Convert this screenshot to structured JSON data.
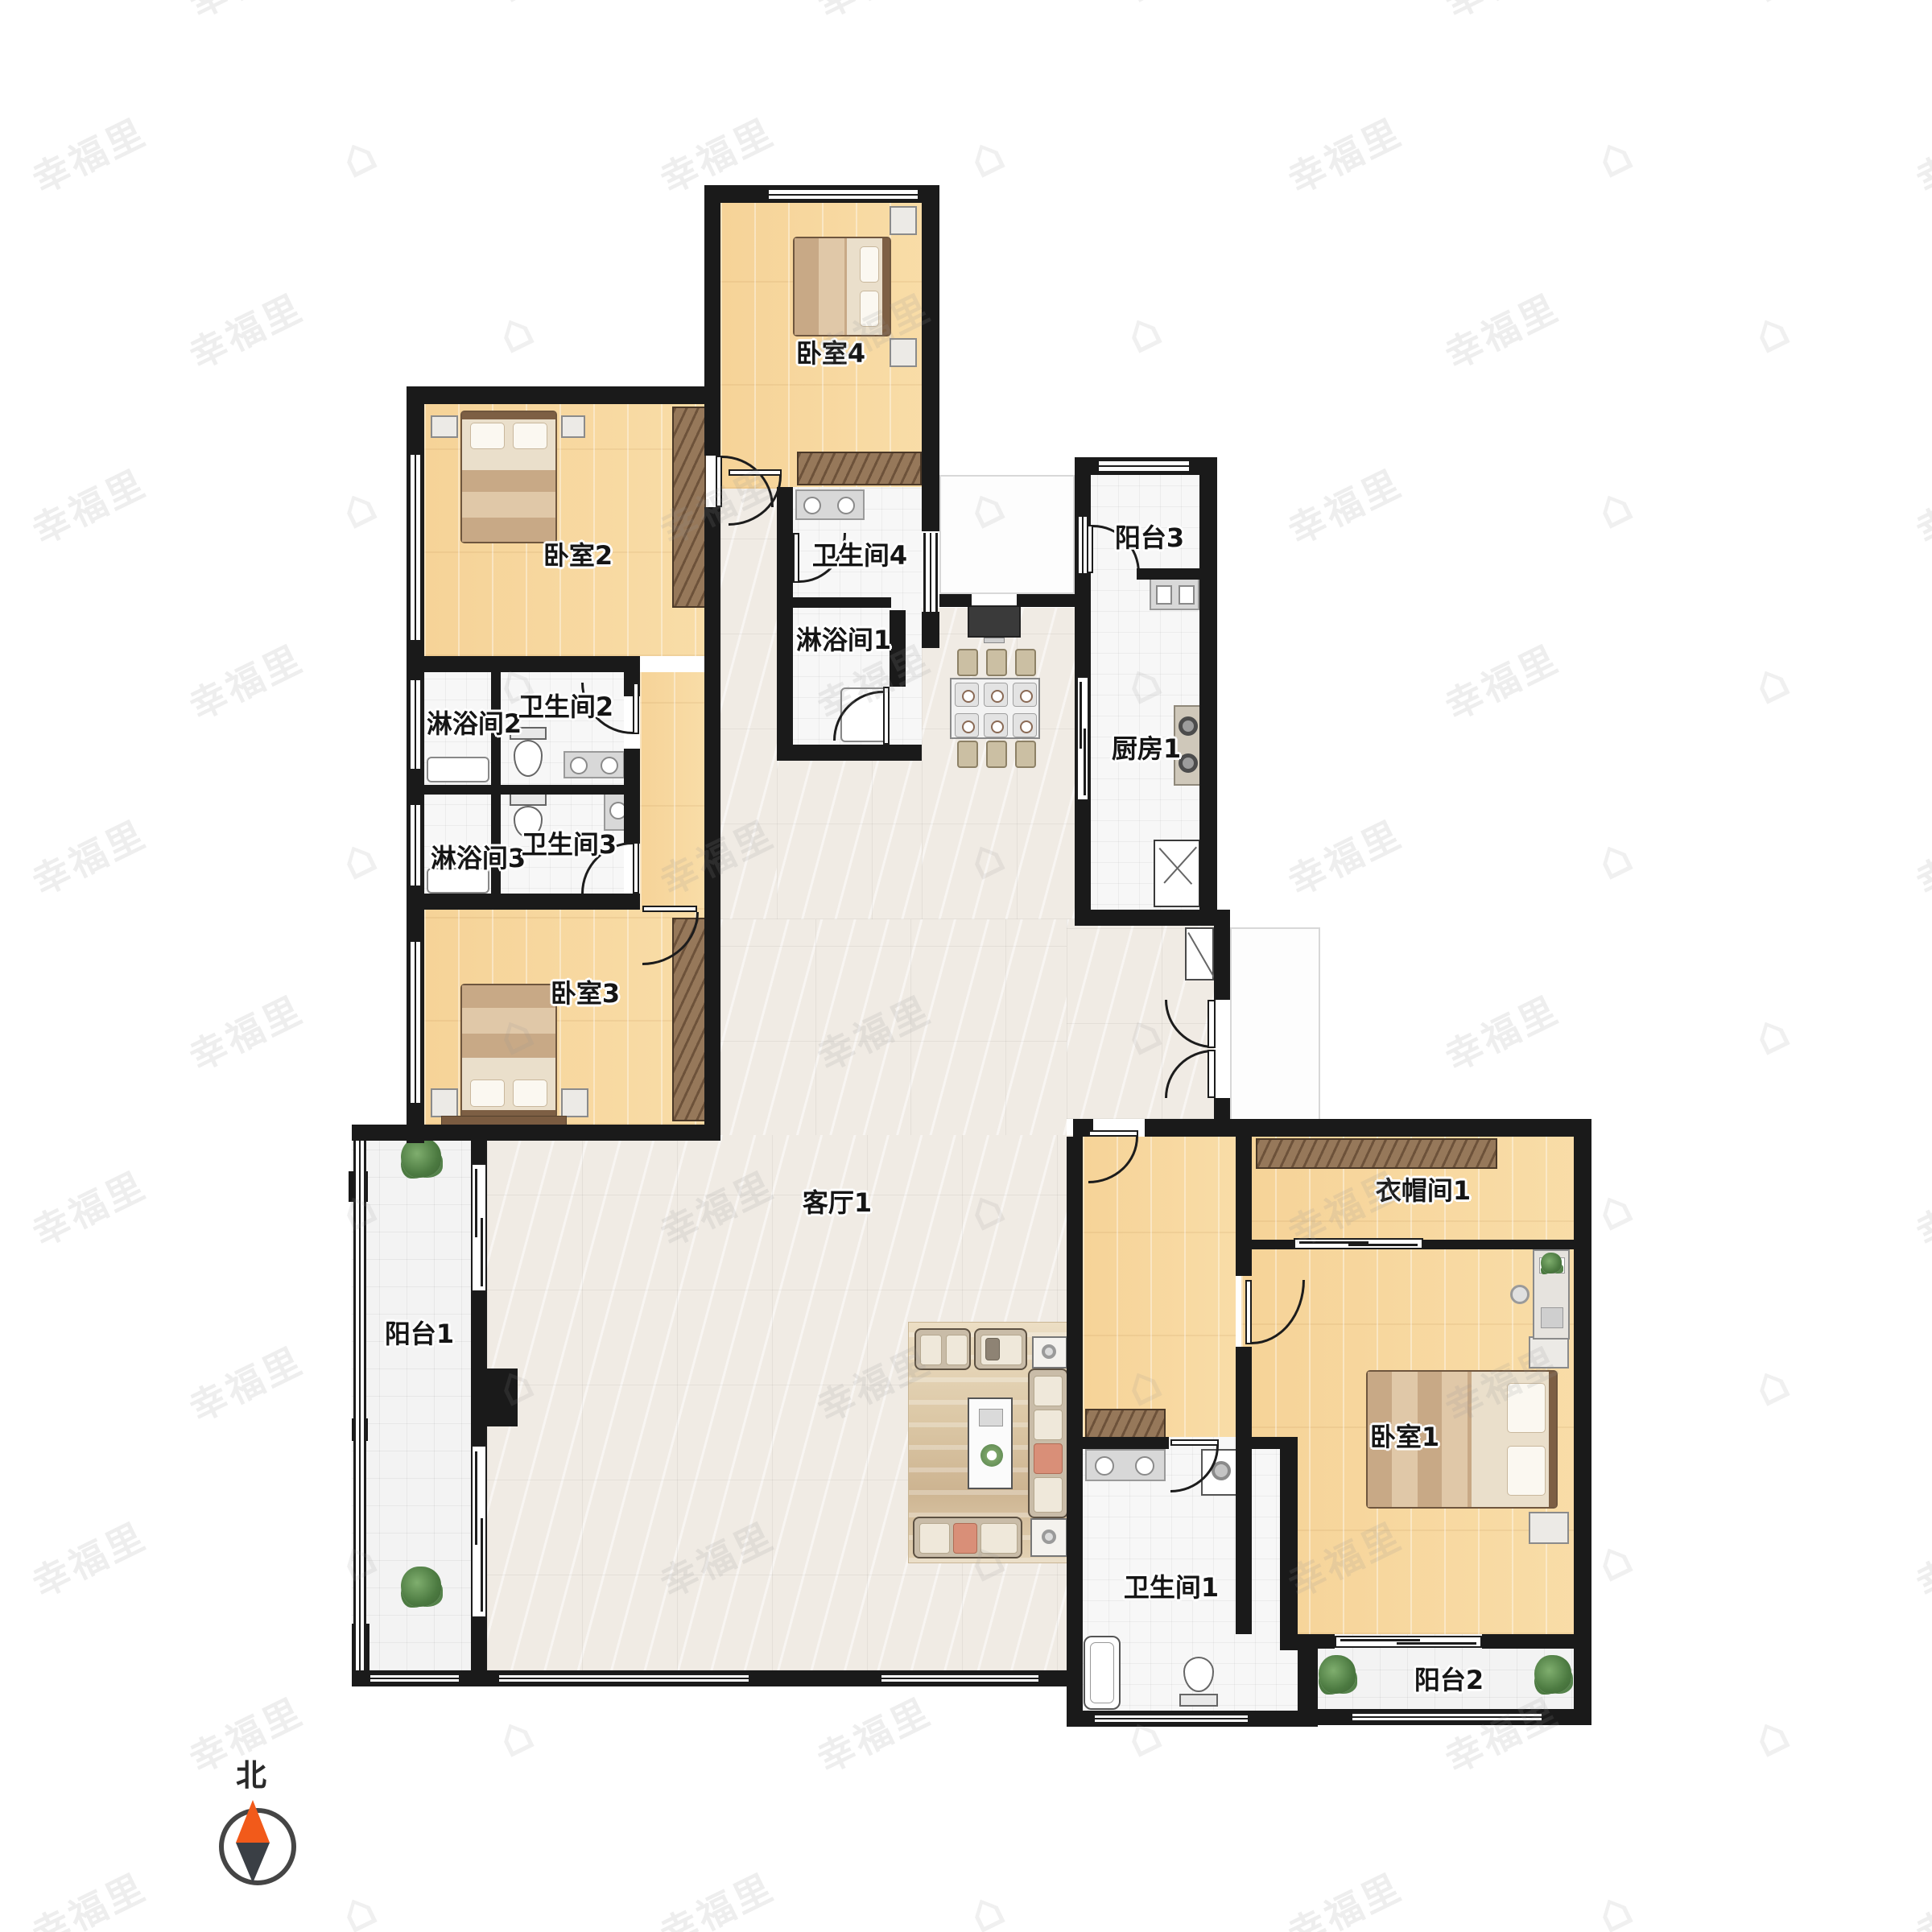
{
  "watermark": {
    "text": "幸福里",
    "icon": "house-icon"
  },
  "compass": {
    "north_label": "北",
    "north_color": "#f25a1a",
    "south_color": "#3a3f45"
  },
  "rooms": {
    "bedroom4": {
      "label": "卧室4"
    },
    "bathroom4": {
      "label": "卫生间4"
    },
    "shower1": {
      "label": "淋浴间1"
    },
    "bedroom2": {
      "label": "卧室2"
    },
    "shower2": {
      "label": "淋浴间2"
    },
    "bathroom2": {
      "label": "卫生间2"
    },
    "shower3": {
      "label": "淋浴间3"
    },
    "bathroom3": {
      "label": "卫生间3"
    },
    "bedroom3": {
      "label": "卧室3"
    },
    "balcony3": {
      "label": "阳台3"
    },
    "kitchen1": {
      "label": "厨房1"
    },
    "living1": {
      "label": "客厅1"
    },
    "balcony1": {
      "label": "阳台1"
    },
    "cloakroom1": {
      "label": "衣帽间1"
    },
    "bedroom1": {
      "label": "卧室1"
    },
    "bathroom1": {
      "label": "卫生间1"
    },
    "balcony2": {
      "label": "阳台2"
    }
  },
  "colors": {
    "wall": "#1a1a1a",
    "wood_floor": "#f7d9a2",
    "marble_floor": "#f0ebe4",
    "tile_floor": "#f7f7f7"
  }
}
